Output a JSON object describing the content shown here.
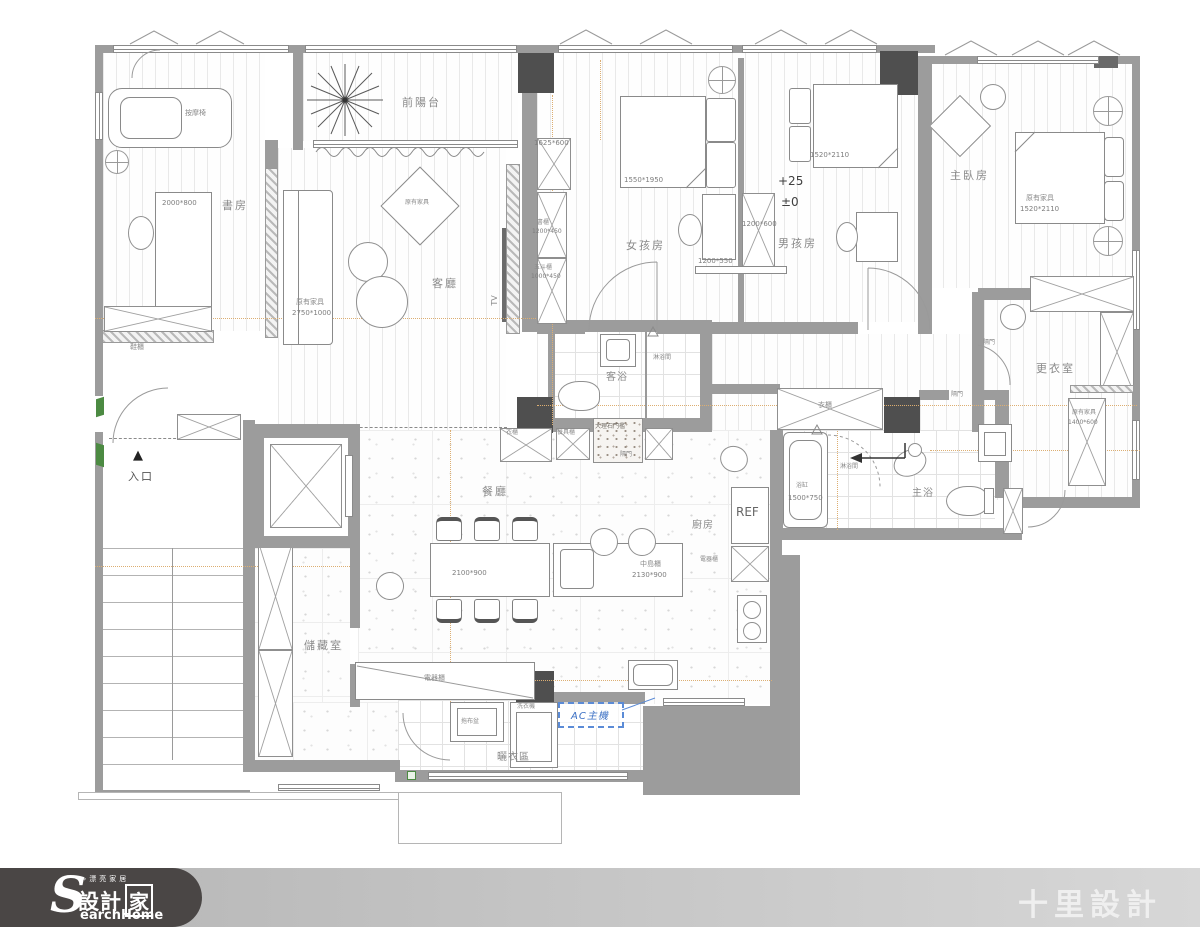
{
  "plan": {
    "rooms": {
      "study": "書房",
      "balcony": "前陽台",
      "living": "客廳",
      "girls": "女孩房",
      "boys": "男孩房",
      "master": "主臥房",
      "dressing": "更衣室",
      "guest_bath": "客浴",
      "master_bath": "主浴",
      "dining": "餐廳",
      "kitchen": "廚房",
      "storage": "儲藏室",
      "laundry": "曬衣區",
      "entrance": "入口"
    },
    "levels": {
      "upper": "+25",
      "zero": "±0"
    },
    "furniture": {
      "massage_chair": "按摩椅",
      "study_desk_dim": "2000*800",
      "shoe_cabinet": "鞋櫃",
      "existing": "原有家具",
      "sofa_dim": "2750*1000",
      "tv": "TV",
      "cabinet_dim": "1625*600",
      "bookcase": "書櫃",
      "bookcase_dim": "1200*450",
      "chest": "五斗櫃",
      "chest_dim": "1000*450",
      "girls_bed_dim": "1550*1950",
      "girls_desk_dim": "1200*550",
      "divider_dim": "1200*600",
      "boys_bed_dim": "1520*2110",
      "master_bed_dim": "1520*2110",
      "dresser_dim": "1400*600",
      "closet": "衣櫃",
      "cupboard": "餐具櫃",
      "marble_threshold": "大理石門檻",
      "partition_door": "隔門",
      "shower": "淋浴間",
      "bathtub": "浴缸",
      "bathtub_dim": "1500*750",
      "fridge": "REF",
      "appliance_cabinet": "電器櫃",
      "dining_table_dim": "2100*900",
      "island": "中島櫃",
      "island_dim": "2130*900",
      "washer": "洗衣機",
      "mop_sink": "拖布盆",
      "ac_unit": "AC主機",
      "entry_mark": "▲"
    },
    "colors": {
      "wall": "#9c9c9c",
      "column": "#4f4f4f",
      "ac_accent": "#4a7fd4",
      "label": "#8a8a8a"
    }
  },
  "footer": {
    "tagline": "»漂亮家居",
    "brand_initial": "S",
    "brand_cn_1": "設計",
    "brand_cn_2": "家",
    "brand_en": "earchHome",
    "designer": "十里設計"
  }
}
